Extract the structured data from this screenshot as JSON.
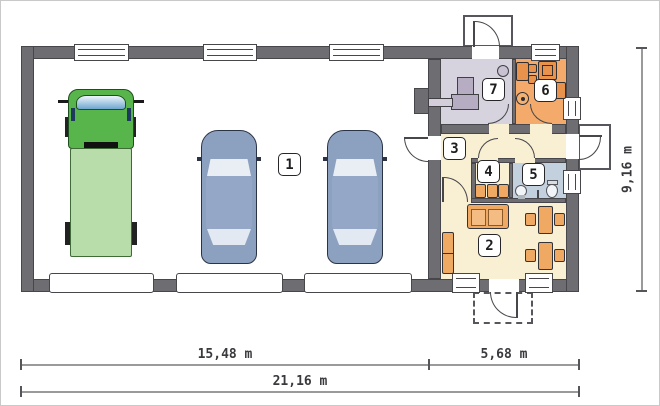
{
  "room_labels": {
    "room1": "1",
    "room2": "2",
    "room3": "3",
    "room4": "4",
    "room5": "5",
    "room6": "6",
    "room7": "7"
  },
  "dimensions": {
    "garage_section_width": "15,48 m",
    "living_section_width": "5,68 m",
    "total_width": "21,16 m",
    "building_depth": "9,16 m"
  },
  "colors": {
    "wall": "#6d6d72",
    "outline": "#46464b",
    "boiler_room_floor": "#d7d3de",
    "kitchen_floor": "#f3aa6b",
    "bathroom_floor": "#c3d0dd",
    "cream_floor": "#f9efd2",
    "furniture_orange": "#efa963",
    "truck_cab_green": "#58b54c",
    "truck_bed_green": "#b9dcab",
    "car_blue": "#8ca0c0"
  }
}
